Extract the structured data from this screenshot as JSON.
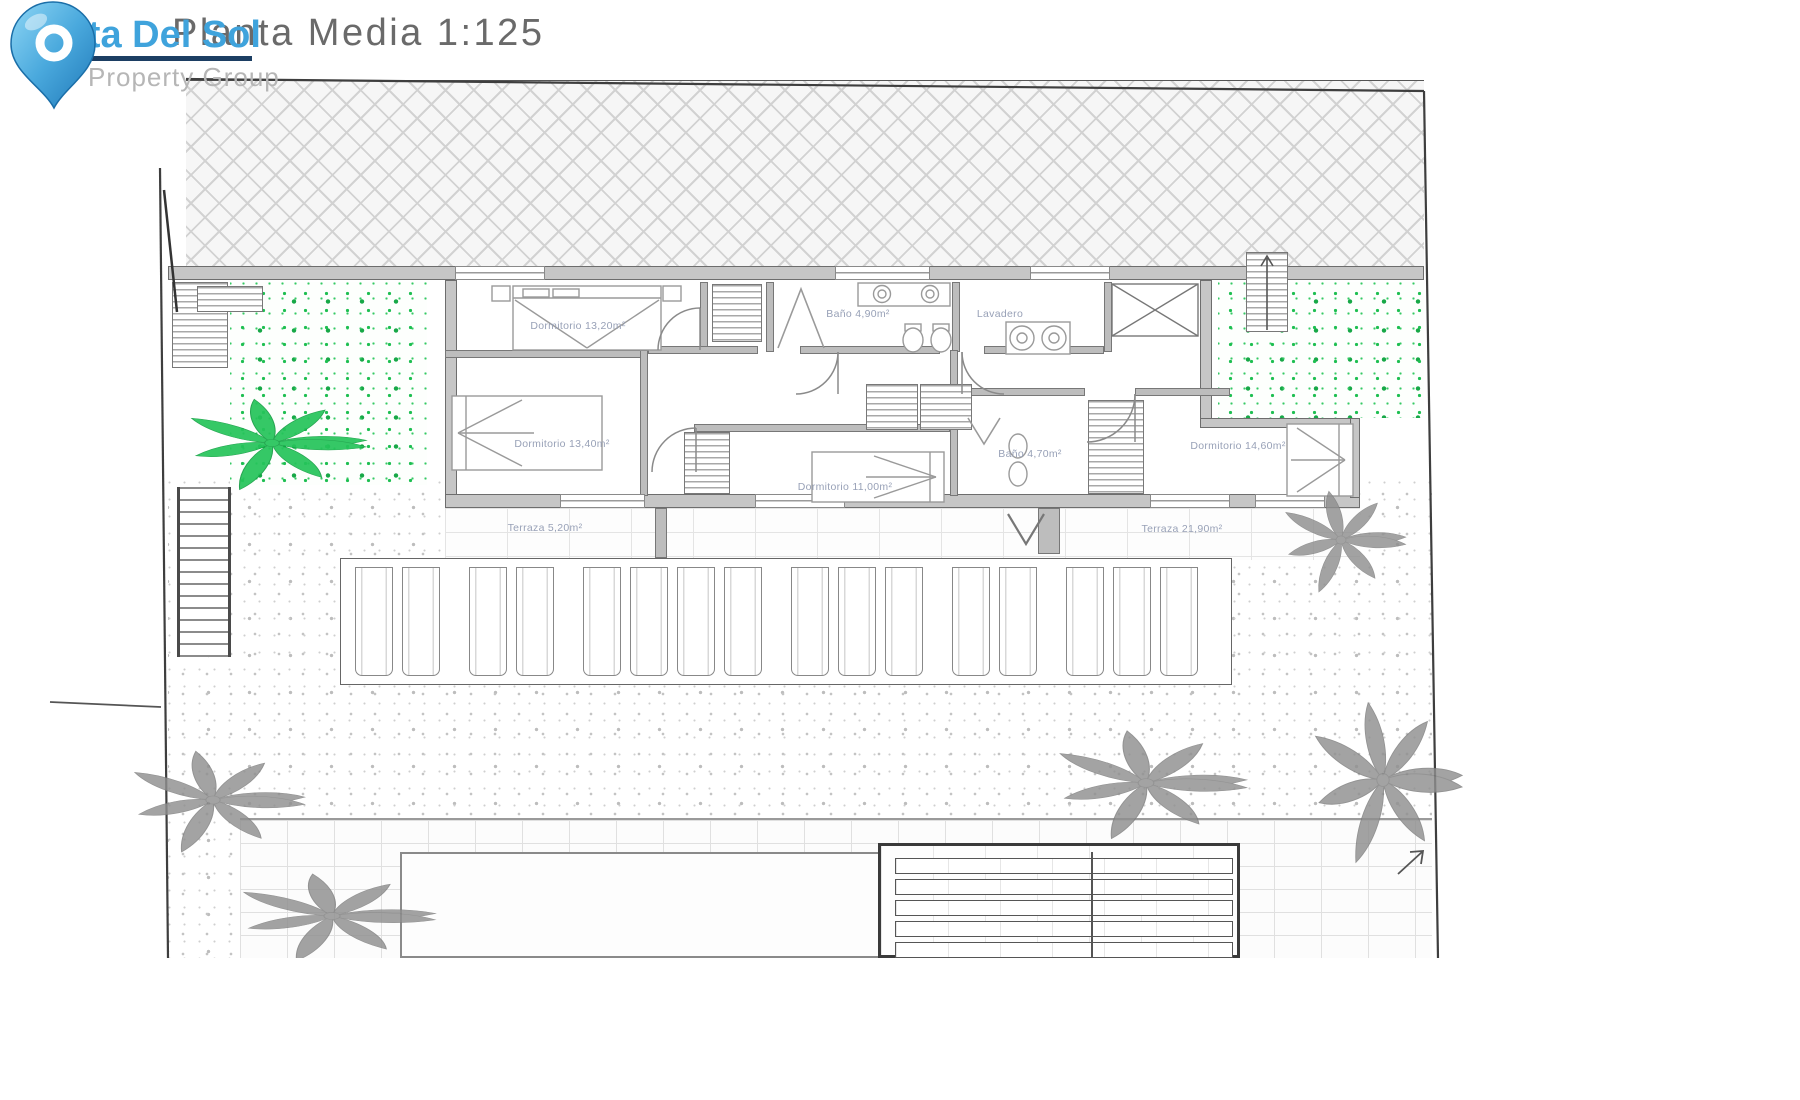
{
  "header": {
    "title": "Planta Media 1:125",
    "logo": {
      "name": "Costa Del Sol",
      "tagline": "Property Group"
    }
  },
  "rooms": [
    {
      "id": "dormitorio-1",
      "label": "Dormitorio 13,20m²"
    },
    {
      "id": "bano-1",
      "label": "Baño 4,90m²"
    },
    {
      "id": "lavadero",
      "label": "Lavadero"
    },
    {
      "id": "dormitorio-2",
      "label": "Dormitorio 13,40m²"
    },
    {
      "id": "dormitorio-3",
      "label": "Dormitorio 11,00m²"
    },
    {
      "id": "bano-2",
      "label": "Baño 4,70m²"
    },
    {
      "id": "dormitorio-4",
      "label": "Dormitorio 14,60m²"
    },
    {
      "id": "terraza-1",
      "label": "Terraza 5,20m²"
    },
    {
      "id": "terraza-2",
      "label": "Terraza 21,90m²"
    }
  ],
  "colors": {
    "logo_blue": "#3fa3dc",
    "logo_navy": "#1c3e63",
    "logo_tagline_gray": "#b6b6b6",
    "title_gray": "#6a6a6a",
    "room_label": "#98a1b7",
    "garden_green": "#25c45a",
    "palm_gray": "#8f8f8f",
    "wall_gray": "#c6c6c6",
    "boundary_line": "#3e3e3e"
  }
}
